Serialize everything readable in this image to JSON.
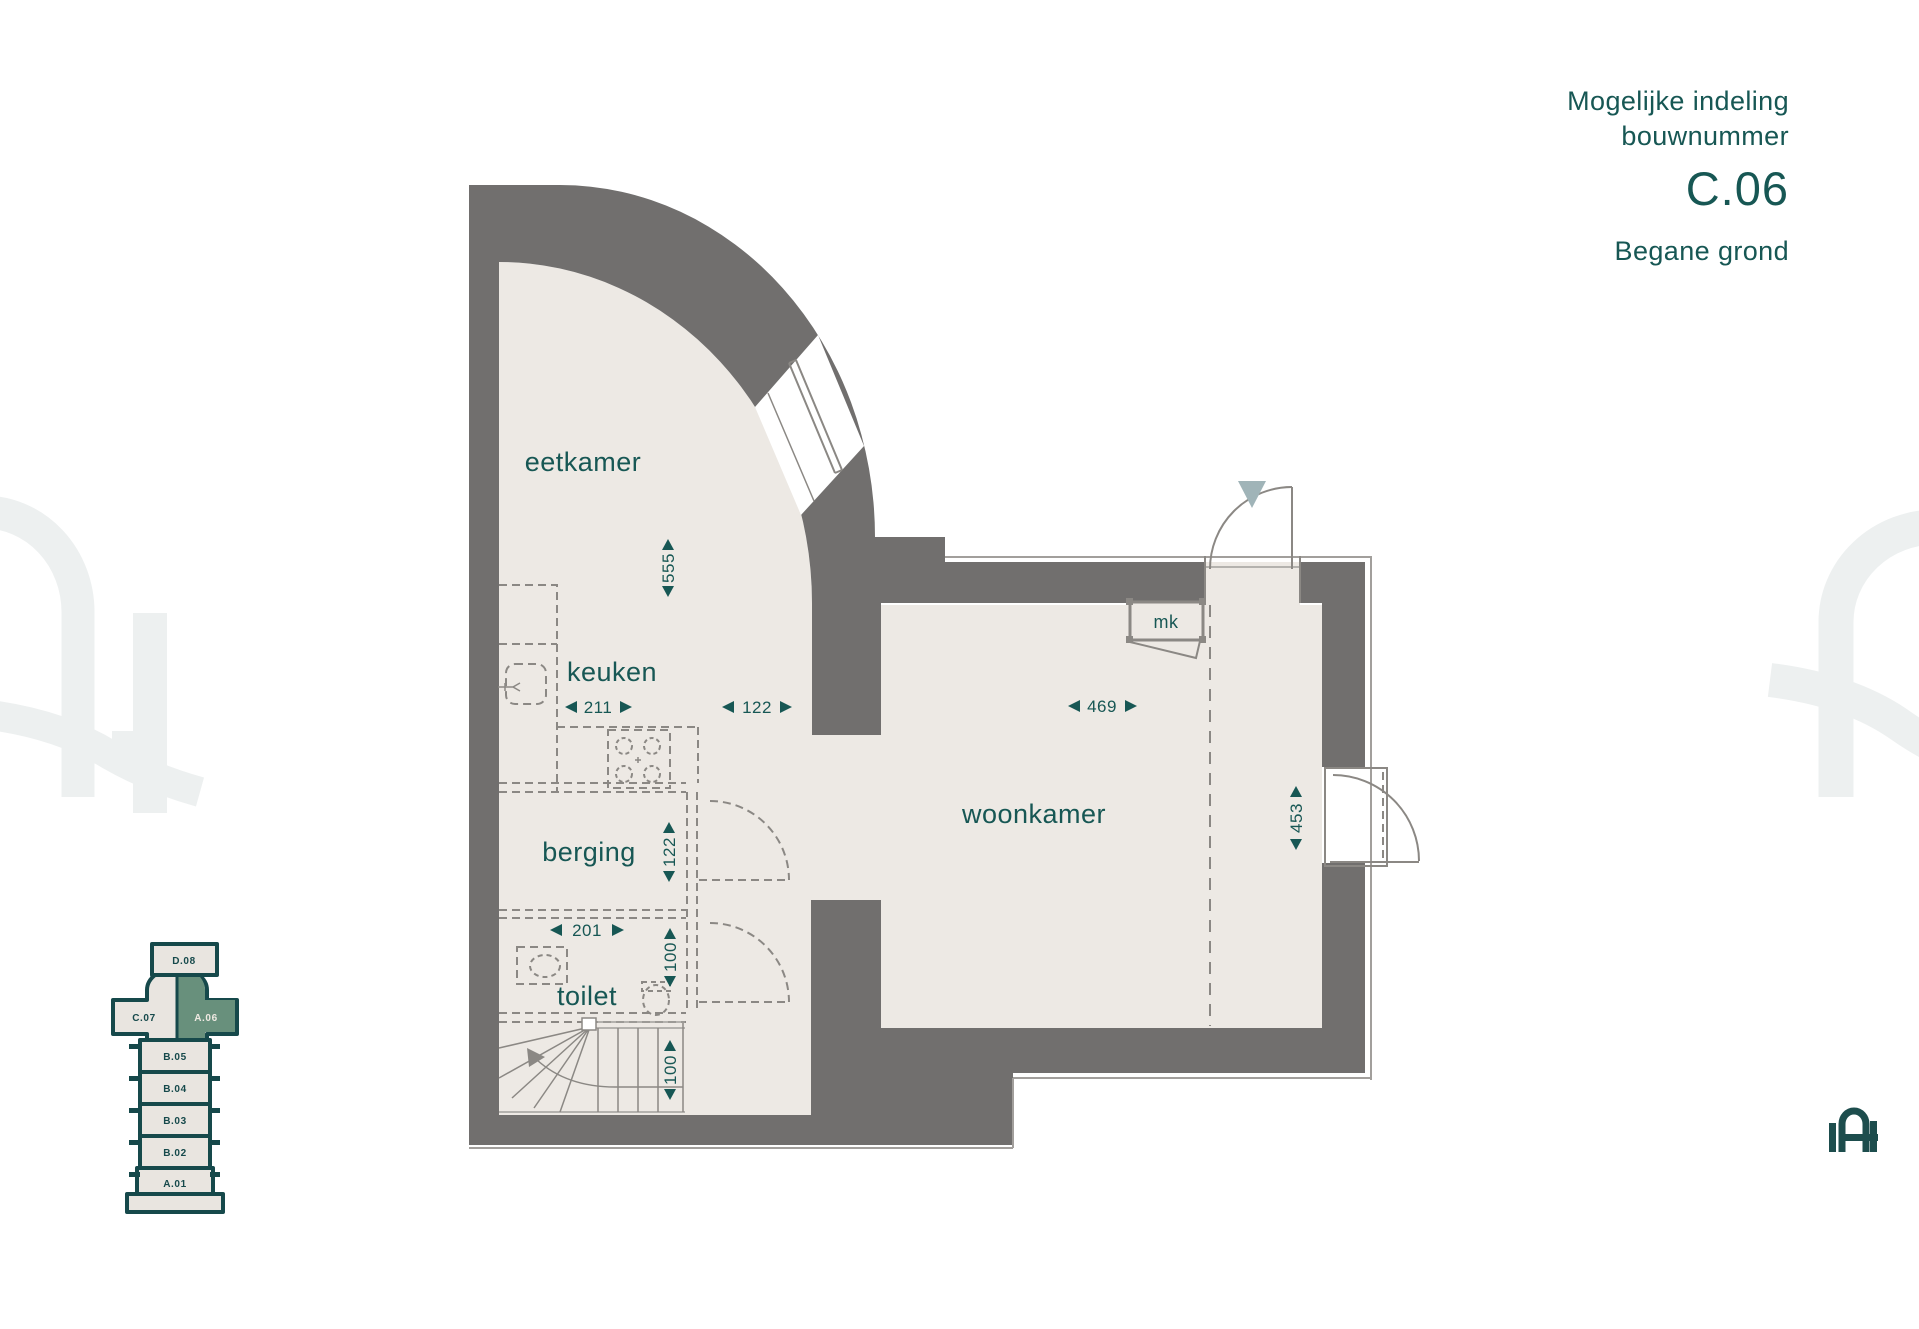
{
  "header": {
    "line1": "Mogelijke indeling",
    "line2": "bouwnummer",
    "unit": "C.06",
    "floor": "Begane grond"
  },
  "floor_plan": {
    "rooms": [
      {
        "label": "eetkamer"
      },
      {
        "label": "keuken"
      },
      {
        "label": "berging"
      },
      {
        "label": "toilet"
      },
      {
        "label": "woonkamer"
      },
      {
        "label": "mk"
      }
    ],
    "dimensions": {
      "eetkamer_depth": "555",
      "keuken_width": "211",
      "passage_width": "122",
      "woonkamer_width": "469",
      "berging_depth": "122",
      "toilet_width": "201",
      "toilet_depth": "100",
      "stair_width": "100",
      "woonkamer_depth": "453"
    }
  },
  "site_plan": {
    "units": [
      {
        "id": "D.08",
        "highlighted": false
      },
      {
        "id": "C.07",
        "highlighted": false
      },
      {
        "id": "A.06",
        "highlighted": true
      },
      {
        "id": "B.05",
        "highlighted": false
      },
      {
        "id": "B.04",
        "highlighted": false
      },
      {
        "id": "B.03",
        "highlighted": false
      },
      {
        "id": "B.02",
        "highlighted": false
      },
      {
        "id": "A.01",
        "highlighted": false
      }
    ],
    "highlight_color": "#68907c"
  },
  "colors": {
    "accent": "#175754",
    "wall": "#716f6e",
    "floor": "#ede9e4",
    "entry_marker": "#a0b4b8",
    "watermark": "#edf0f0"
  }
}
